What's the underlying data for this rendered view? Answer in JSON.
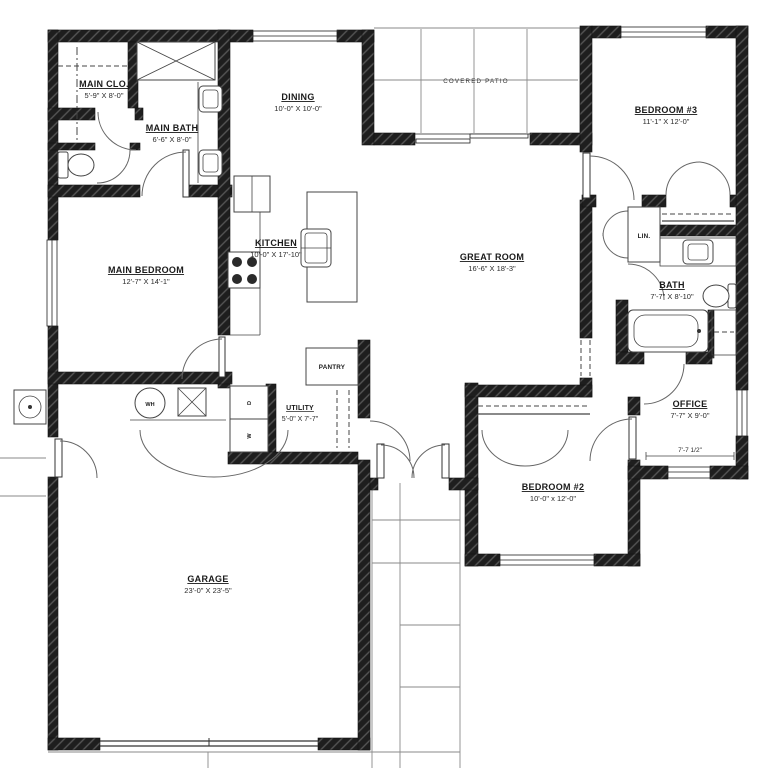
{
  "plan": {
    "rooms": {
      "main_closet": {
        "name": "MAIN CLO.",
        "dims": "5'-9\" X 8'-0\""
      },
      "main_bath": {
        "name": "MAIN BATH",
        "dims": "6'-6\" X 8'-0\""
      },
      "dining": {
        "name": "DINING",
        "dims": "10'-0\" X 10'-0\""
      },
      "bedroom3": {
        "name": "BEDROOM #3",
        "dims": "11'-1\" X 12'-0\""
      },
      "main_bedroom": {
        "name": "MAIN BEDROOM",
        "dims": "12'-7\" X 14'-1\""
      },
      "kitchen": {
        "name": "KITCHEN",
        "dims": "10'-0\" X 17'-10\""
      },
      "great_room": {
        "name": "GREAT ROOM",
        "dims": "16'-6\" X 18'-3\""
      },
      "bath": {
        "name": "BATH",
        "dims": "7'-7\" X 8'-10\""
      },
      "office": {
        "name": "OFFICE",
        "dims": "7'-7\" X 9'-0\"",
        "floor_dim": "7'-7 1/2\""
      },
      "bedroom2": {
        "name": "BEDROOM #2",
        "dims": "10'-0\" x 12'-0\""
      },
      "utility": {
        "name": "UTILITY",
        "dims": "5'-0\" X 7'-7\""
      },
      "garage": {
        "name": "GARAGE",
        "dims": "23'-0\" X 23'-5\""
      }
    },
    "areas": {
      "covered_patio": "COVERED PATIO",
      "pantry": "PANTRY",
      "linen": "LIN."
    },
    "appliances": {
      "water_heater": "WH",
      "dryer": "D",
      "washer": "W"
    }
  }
}
